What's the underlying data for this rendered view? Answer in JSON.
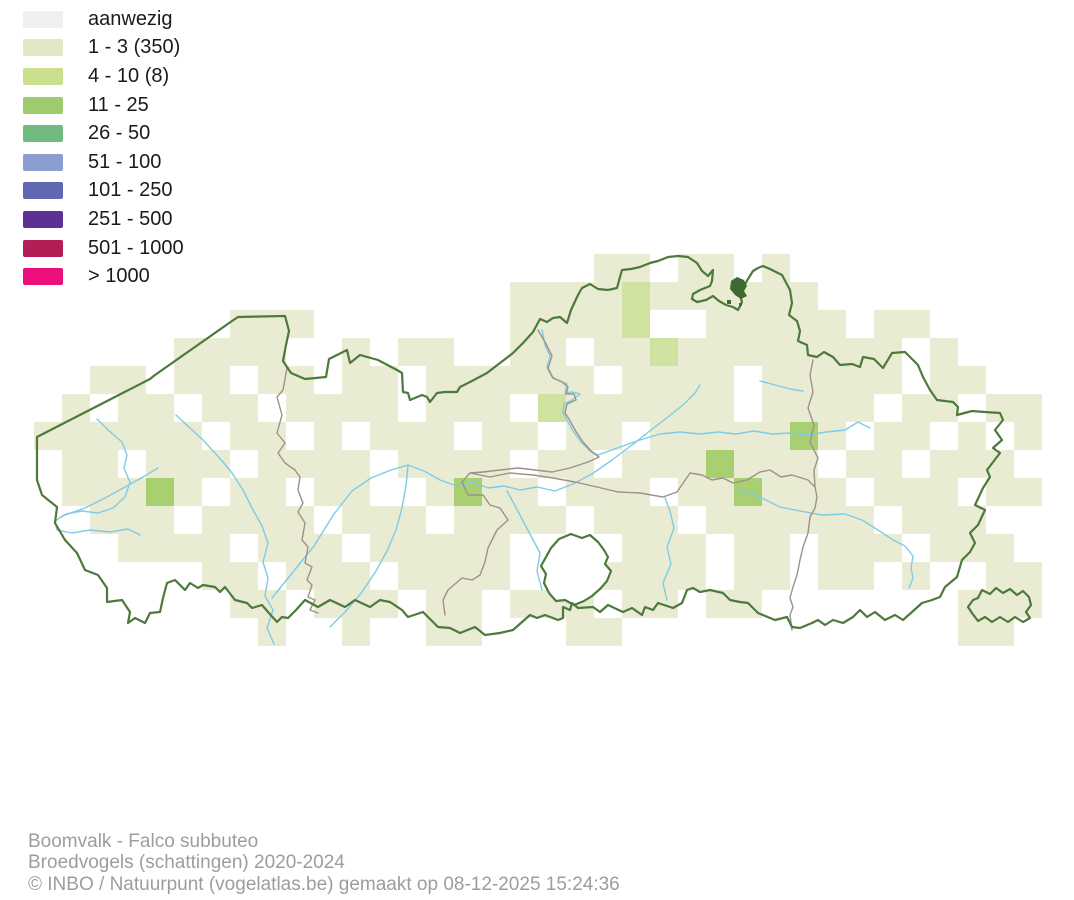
{
  "legend": {
    "items": [
      {
        "label": "aanwezig",
        "color": "#efefef"
      },
      {
        "label": "1 - 3 (350)",
        "color": "#e4e7c3"
      },
      {
        "label": "4 - 10 (8)",
        "color": "#c9df8e"
      },
      {
        "label": "11 - 25",
        "color": "#9ecb6d"
      },
      {
        "label": "26 - 50",
        "color": "#71ba7d"
      },
      {
        "label": "51 - 100",
        "color": "#8b9dd1"
      },
      {
        "label": "101 - 250",
        "color": "#5f68b0"
      },
      {
        "label": "251 - 500",
        "color": "#5e3095"
      },
      {
        "label": "501 - 1000",
        "color": "#b21e55"
      },
      {
        "label": "> 1000",
        "color": "#ec0f7e"
      }
    ]
  },
  "footer": {
    "line1": "Boomvalk - Falco subbuteo",
    "line2": "Broedvogels (schattingen) 2020-2024",
    "line3": "© INBO / Natuurpunt (vogelatlas.be) gemaakt op 08-12-2025 15:24:36"
  },
  "map": {
    "colors": {
      "region_border": "#4d793c",
      "province_border": "#9d9289",
      "river": "#7fcbe7",
      "docks": "#3d6a31",
      "enclave_fill": "#ffffff"
    },
    "grid": {
      "origin_x": 34,
      "origin_y": 254,
      "cell_size": 28,
      "cell_colors": {
        "1": "#e9ecd3",
        "2": "#cfe2a0",
        "3": "#a8d071"
      },
      "rows": [
        "....................11.11.1.........",
        ".................11112111111........",
        ".......111.......11112..11111.11....",
        ".....1111..1.11..11.11211111111.1...",
        "..11.11.11.11.111111.1111.11111.11..",
        ".1.11.11.1111.111.2111111.1111.11.11",
        "111111.11.1.111.11.11.1111131.11.1.1",
        ".11.111.1111.1111.11.1113111.11.111.",
        ".11131.11.11..1311.111.113111.111.11",
        "..111.1111.111.1111.111.111111.111..",
        "...1111.111.11111....111.11.111.111.",
        "......11.111.1111...1111.11.11.1..11",
        ".......11.111.11.111.11.11.......111",
        "........1..1..11...11............11."
      ]
    }
  }
}
